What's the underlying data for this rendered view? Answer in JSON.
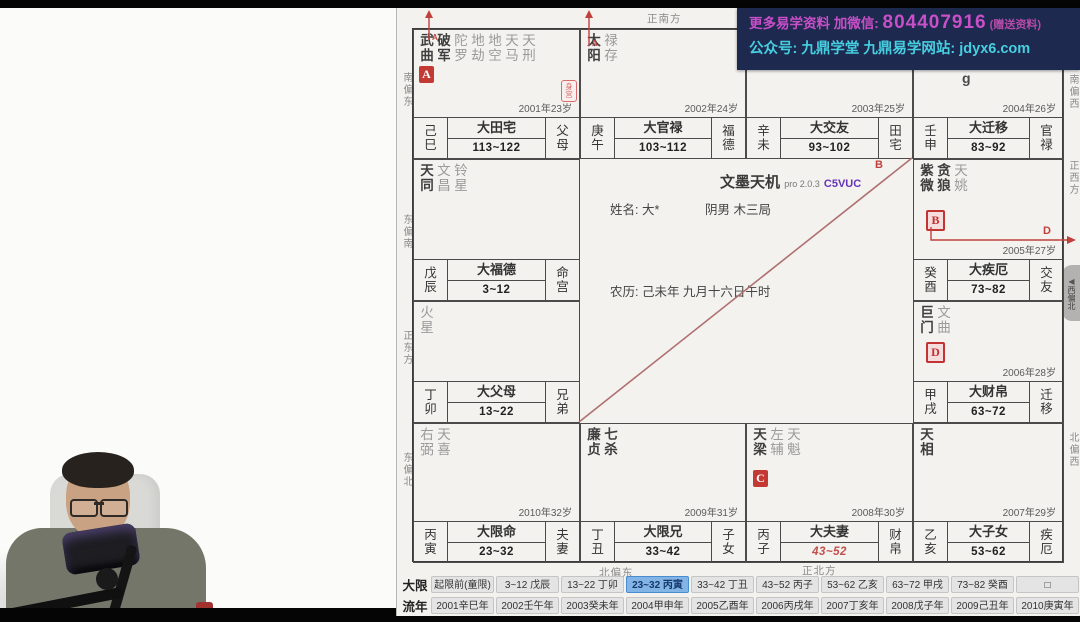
{
  "banner": {
    "line1_prefix": "更多易学资料 加微信: ",
    "line1_number": "804407916",
    "line1_suffix": " (赠送资料)",
    "line2": "公众号: 九鼎学堂 九鼎易学网站: jdyx6.com",
    "bg_color": "#1e2950",
    "magenta": "#c74fc7",
    "cyan": "#46cfe0"
  },
  "center": {
    "title": "文墨天机",
    "version": "pro 2.0.3",
    "edition": "C5VUC",
    "name_label": "姓名: 大*",
    "gender_info": "阴男 木三局",
    "lunar_info": "农历: 己未年 九月十六日午时"
  },
  "directions": {
    "top": "正南方",
    "bottom_left": "北偏东",
    "bottom_right": "正北方",
    "left": [
      "南偏东",
      "东偏南",
      "正东方",
      "东偏北"
    ],
    "right": [
      "南偏西",
      "正西方",
      "北偏西"
    ],
    "bubble_text": "西偏北",
    "bubble_arrow": "◀"
  },
  "chart": {
    "annotations": {
      "diag_label": "B",
      "elbow_label": "D",
      "arrow1_label": "A",
      "arrow2_label": "A",
      "accent_red": "#c2403c",
      "line_maroon": "#b07070"
    },
    "body_seal_text": "身宫",
    "watermark_partial": "g",
    "palaces": [
      {
        "pos": "r1c1",
        "stars": [
          {
            "n": "武曲",
            "main": true
          },
          {
            "n": "破军",
            "main": true
          },
          {
            "n": "陀罗"
          },
          {
            "n": "地劫"
          },
          {
            "n": "地空"
          },
          {
            "n": "天马"
          },
          {
            "n": "天刑"
          }
        ],
        "badge": "A",
        "badge_style": "solid",
        "body_seal": true,
        "year": "2001年23岁",
        "stem": "己",
        "branch": "巳",
        "da_palace": "大田宅",
        "age_range": "113~122",
        "palace": "父母"
      },
      {
        "pos": "r1c2",
        "stars": [
          {
            "n": "太阳",
            "main": true
          },
          {
            "n": "禄存"
          }
        ],
        "year": "2002年24岁",
        "stem": "庚",
        "branch": "午",
        "da_palace": "大官禄",
        "age_range": "103~112",
        "palace": "福德"
      },
      {
        "pos": "r1c3",
        "stars": [],
        "year": "2003年25岁",
        "stem": "辛",
        "branch": "未",
        "da_palace": "大交友",
        "age_range": "93~102",
        "palace": "田宅"
      },
      {
        "pos": "r1c4",
        "stars": [],
        "partial": "g",
        "year": "2004年26岁",
        "stem": "壬",
        "branch": "申",
        "da_palace": "大迁移",
        "age_range": "83~92",
        "palace": "官禄"
      },
      {
        "pos": "r2c4",
        "stars": [
          {
            "n": "紫微",
            "main": true
          },
          {
            "n": "贪狼",
            "main": true
          },
          {
            "n": "天姚"
          }
        ],
        "badge": "B",
        "badge_style": "outline",
        "year": "2005年27岁",
        "stem": "癸",
        "branch": "酉",
        "da_palace": "大疾厄",
        "age_range": "73~82",
        "palace": "交友"
      },
      {
        "pos": "r3c4",
        "stars": [
          {
            "n": "巨门",
            "main": true
          },
          {
            "n": "文曲"
          }
        ],
        "badge": "D",
        "badge_style": "outline",
        "year": "2006年28岁",
        "stem": "甲",
        "branch": "戌",
        "da_palace": "大财帛",
        "age_range": "63~72",
        "palace": "迁移"
      },
      {
        "pos": "r4c4",
        "stars": [
          {
            "n": "天相",
            "main": true
          }
        ],
        "year": "2007年29岁",
        "stem": "乙",
        "branch": "亥",
        "da_palace": "大子女",
        "age_range": "53~62",
        "palace": "疾厄"
      },
      {
        "pos": "r4c3",
        "stars": [
          {
            "n": "天梁",
            "main": true
          },
          {
            "n": "左辅"
          },
          {
            "n": "天魁"
          }
        ],
        "badge": "C",
        "badge_style": "solid",
        "range_red": true,
        "year": "2008年30岁",
        "stem": "丙",
        "branch": "子",
        "da_palace": "大夫妻",
        "age_range": "43~52",
        "palace": "财帛"
      },
      {
        "pos": "r4c2",
        "stars": [
          {
            "n": "廉贞",
            "main": true
          },
          {
            "n": "七杀",
            "main": true
          }
        ],
        "year": "2009年31岁",
        "stem": "丁",
        "branch": "丑",
        "da_palace": "大限兄",
        "age_range": "33~42",
        "palace": "子女"
      },
      {
        "pos": "r4c1",
        "stars": [
          {
            "n": "右弼"
          },
          {
            "n": "天喜"
          }
        ],
        "year": "2010年32岁",
        "stem": "丙",
        "branch": "寅",
        "da_palace": "大限命",
        "age_range": "23~32",
        "palace": "夫妻"
      },
      {
        "pos": "r3c1",
        "stars": [
          {
            "n": "火星"
          }
        ],
        "year": "",
        "stem": "丁",
        "branch": "卯",
        "da_palace": "大父母",
        "age_range": "13~22",
        "palace": "兄弟"
      },
      {
        "pos": "r2c1",
        "stars": [
          {
            "n": "天同",
            "main": true
          },
          {
            "n": "文昌"
          },
          {
            "n": "铃星"
          }
        ],
        "year": "",
        "stem": "戊",
        "branch": "辰",
        "da_palace": "大福德",
        "age_range": "3~12",
        "palace": "命宫"
      }
    ]
  },
  "toolbar": {
    "rows": [
      {
        "label": "大限",
        "active_index": 3,
        "buttons": [
          "起限前(童限)",
          "3~12 戊辰",
          "13~22 丁卯",
          "23~32 丙寅",
          "33~42 丁丑",
          "43~52 丙子",
          "53~62 乙亥",
          "63~72 甲戌",
          "73~82 癸酉",
          "□"
        ]
      },
      {
        "label": "流年",
        "active_index": -1,
        "buttons": [
          "2001辛巳年",
          "2002壬午年",
          "2003癸未年",
          "2004甲申年",
          "2005乙酉年",
          "2006丙戌年",
          "2007丁亥年",
          "2008戊子年",
          "2009己丑年",
          "2010庚寅年"
        ]
      }
    ]
  }
}
